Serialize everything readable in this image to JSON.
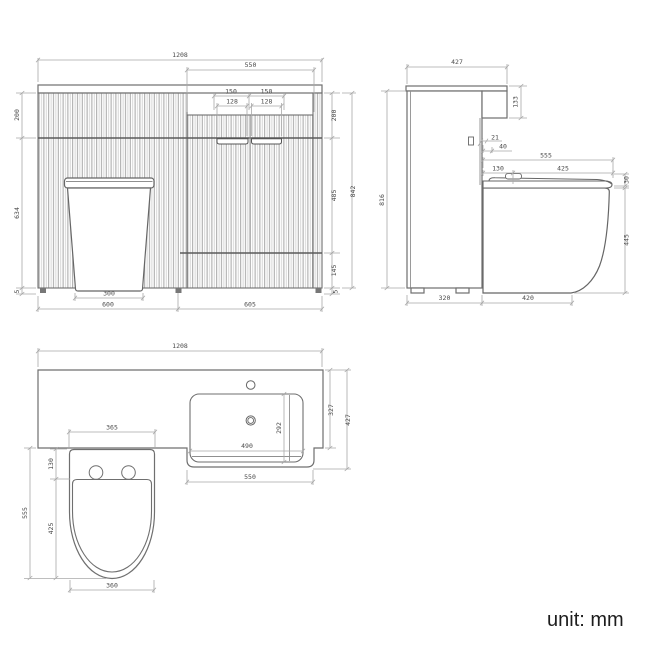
{
  "footer": {
    "unit_label": "unit: mm"
  },
  "colors": {
    "outline": "#6f6f6f",
    "dim_line": "#a9a9a9",
    "dim_text": "#4a4a4a",
    "flute_dark": "#9a9a9a",
    "flute_light": "#d2d2d2",
    "footer_text": "#1d1d1d"
  },
  "views": {
    "front": {
      "total_width": "1208",
      "recess_width": "550",
      "handle_pitch_left": "150",
      "handle_pitch_right": "150",
      "handle_width_left": "128",
      "handle_width_right": "128",
      "top_height_left": "200",
      "top_height_right": "200",
      "overall_height": "842",
      "lower_height_left": "634",
      "middle_height": "485",
      "bottom_height": "145",
      "plinth_left": "5",
      "plinth_right": "5",
      "toilet_base_width": "300",
      "left_unit_width": "600",
      "right_unit_width": "605"
    },
    "side": {
      "top_depth": "427",
      "fascia_height": "133",
      "gap_small": "21",
      "gap_large": "40",
      "seat_depth_total": "555",
      "seat_back_depth": "130",
      "seat_length": "425",
      "seat_thickness": "30",
      "cabinet_height": "816",
      "pan_height": "445",
      "cabinet_depth": "320",
      "pan_projection": "420"
    },
    "plan": {
      "total_width": "1208",
      "depth_max": "427",
      "counter_depth": "327",
      "basin_inner_depth": "292",
      "basin_inner_width": "490",
      "basin_unit_width": "550",
      "toilet_back_width": "365",
      "toilet_back_depth": "130",
      "seat_length": "425",
      "toilet_total_depth": "555",
      "toilet_front_width": "360"
    }
  }
}
